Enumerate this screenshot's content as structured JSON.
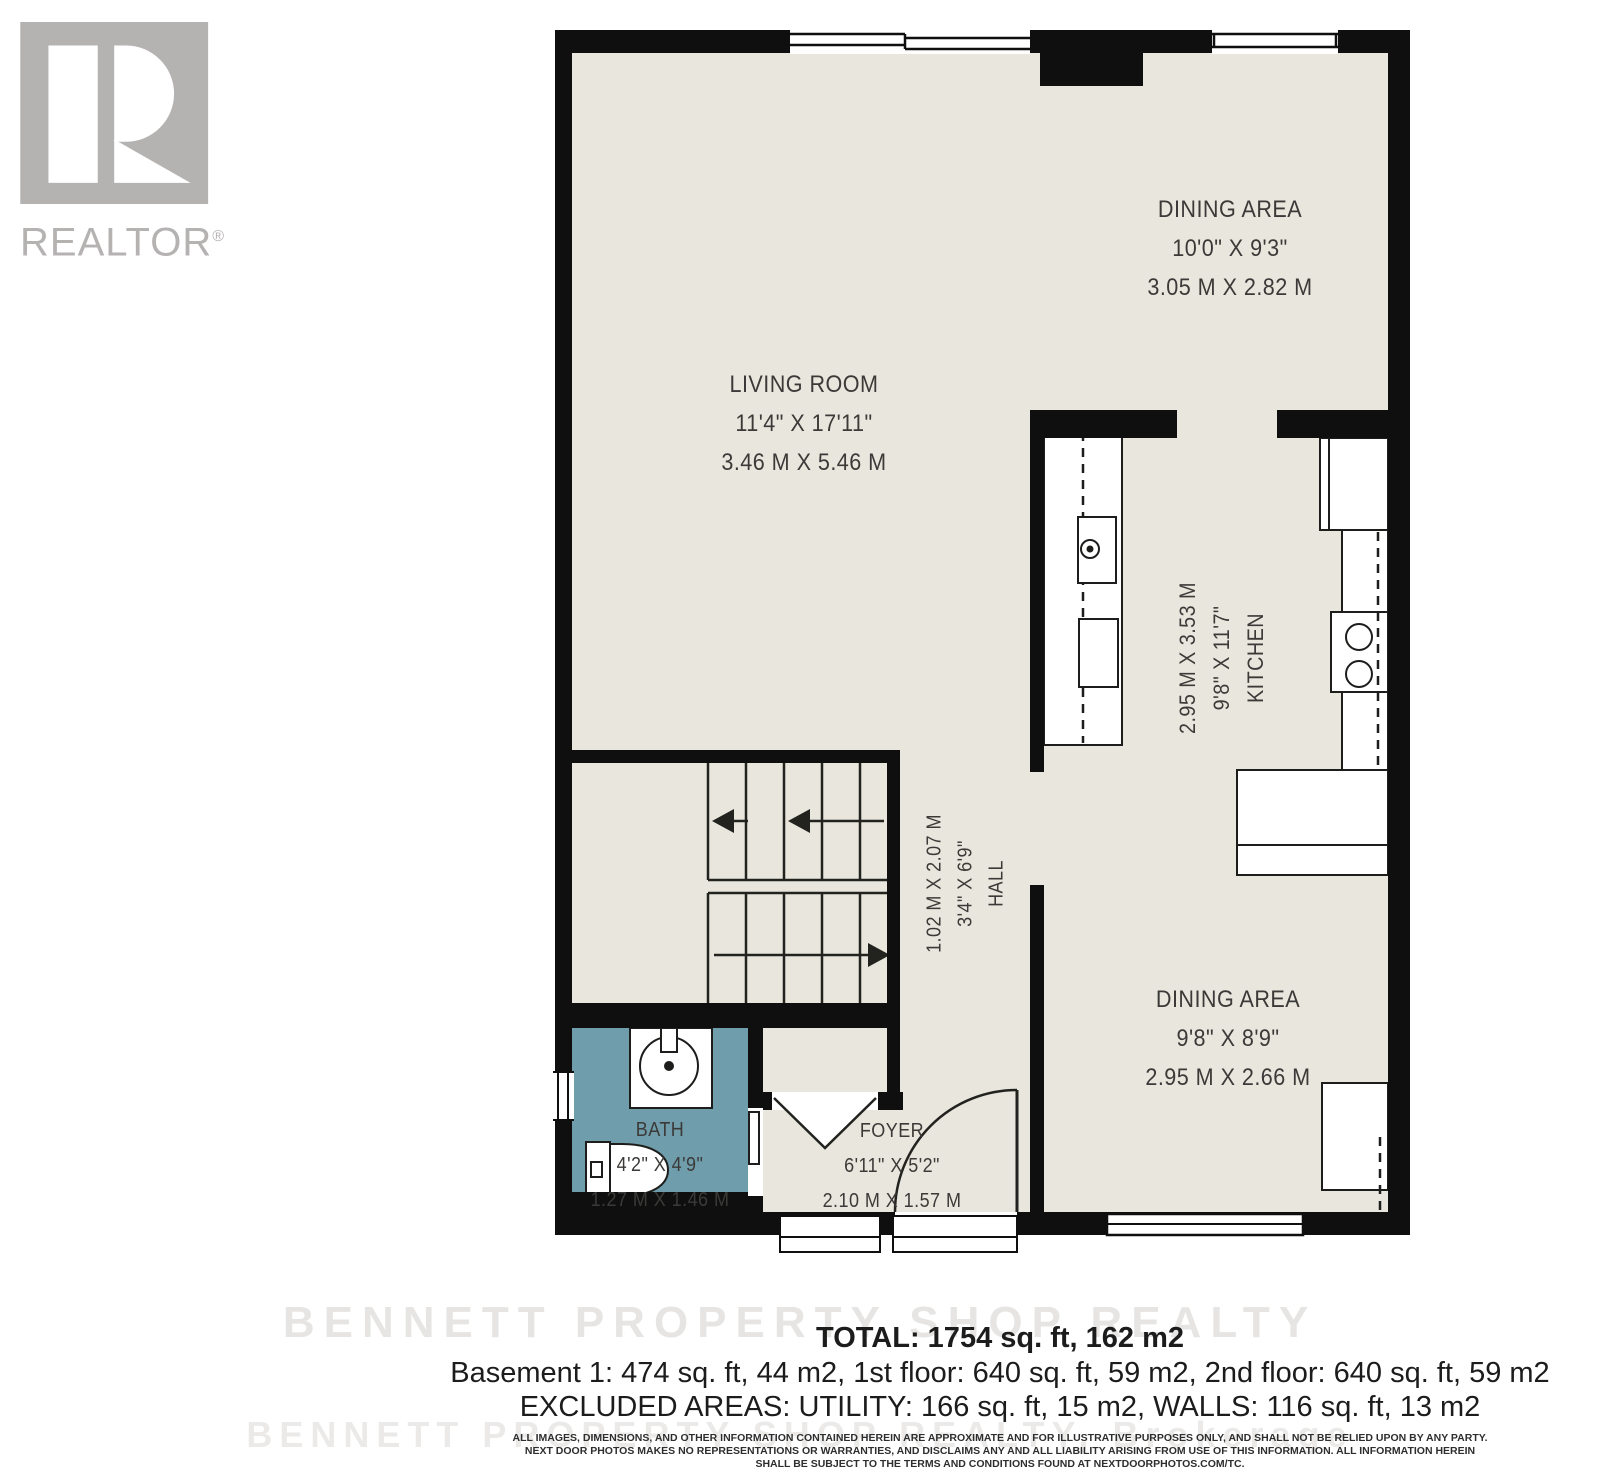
{
  "branding": {
    "logo_text": "REALTOR",
    "registered_mark": "®"
  },
  "rooms": {
    "dining_top": {
      "name": "DINING AREA",
      "imperial": "10'0\" X 9'3\"",
      "metric": "3.05 M X 2.82 M"
    },
    "living": {
      "name": "LIVING ROOM",
      "imperial": "11'4\" X 17'11\"",
      "metric": "3.46 M X 5.46 M"
    },
    "kitchen": {
      "name": "KITCHEN",
      "imperial": "9'8\" X 11'7\"",
      "metric": "2.95 M X 3.53 M"
    },
    "hall": {
      "name": "HALL",
      "imperial": "3'4\" X 6'9\"",
      "metric": "1.02 M X 2.07 M"
    },
    "dining_bottom": {
      "name": "DINING AREA",
      "imperial": "9'8\" X 8'9\"",
      "metric": "2.95 M X 2.66 M"
    },
    "bath": {
      "name": "BATH",
      "imperial": "4'2\" X 4'9\"",
      "metric": "1.27 M X 1.46 M"
    },
    "foyer": {
      "name": "FOYER",
      "imperial": "6'11\" X 5'2\"",
      "metric": "2.10 M X 1.57 M"
    }
  },
  "summary": {
    "total": "TOTAL: 1754 sq. ft, 162 m2",
    "floors": "Basement 1: 474 sq. ft, 44 m2, 1st floor: 640 sq. ft, 59 m2, 2nd floor: 640 sq. ft, 59 m2",
    "excluded": "EXCLUDED AREAS: UTILITY: 166 sq. ft, 15 m2, WALLS: 116 sq. ft, 13 m2"
  },
  "disclaimer": {
    "line1": "ALL IMAGES, DIMENSIONS, AND OTHER INFORMATION CONTAINED HEREIN ARE APPROXIMATE AND FOR ILLUSTRATIVE PURPOSES ONLY, AND SHALL NOT BE RELIED UPON BY ANY PARTY.",
    "line2": "NEXT DOOR PHOTOS MAKES NO REPRESENTATIONS OR WARRANTIES, AND DISCLAIMS ANY AND ALL LIABILITY ARISING FROM USE OF THIS INFORMATION. ALL INFORMATION HEREIN",
    "line3": "SHALL BE SUBJECT TO THE TERMS AND CONDITIONS FOUND AT NEXTDOORPHOTOS.COM/TC."
  },
  "watermark": {
    "line1": "BENNETT PROPERTY SHOP REALTY",
    "line2": "BENNETT PROPERTY SHOP REALTY, Brokerage"
  },
  "colors": {
    "wall": "#0f0f0f",
    "floor": "#e9e7dd",
    "bath_floor": "#6f9dab",
    "label_text": "#3b3a38",
    "logo_gray": "#b5b2b2"
  }
}
